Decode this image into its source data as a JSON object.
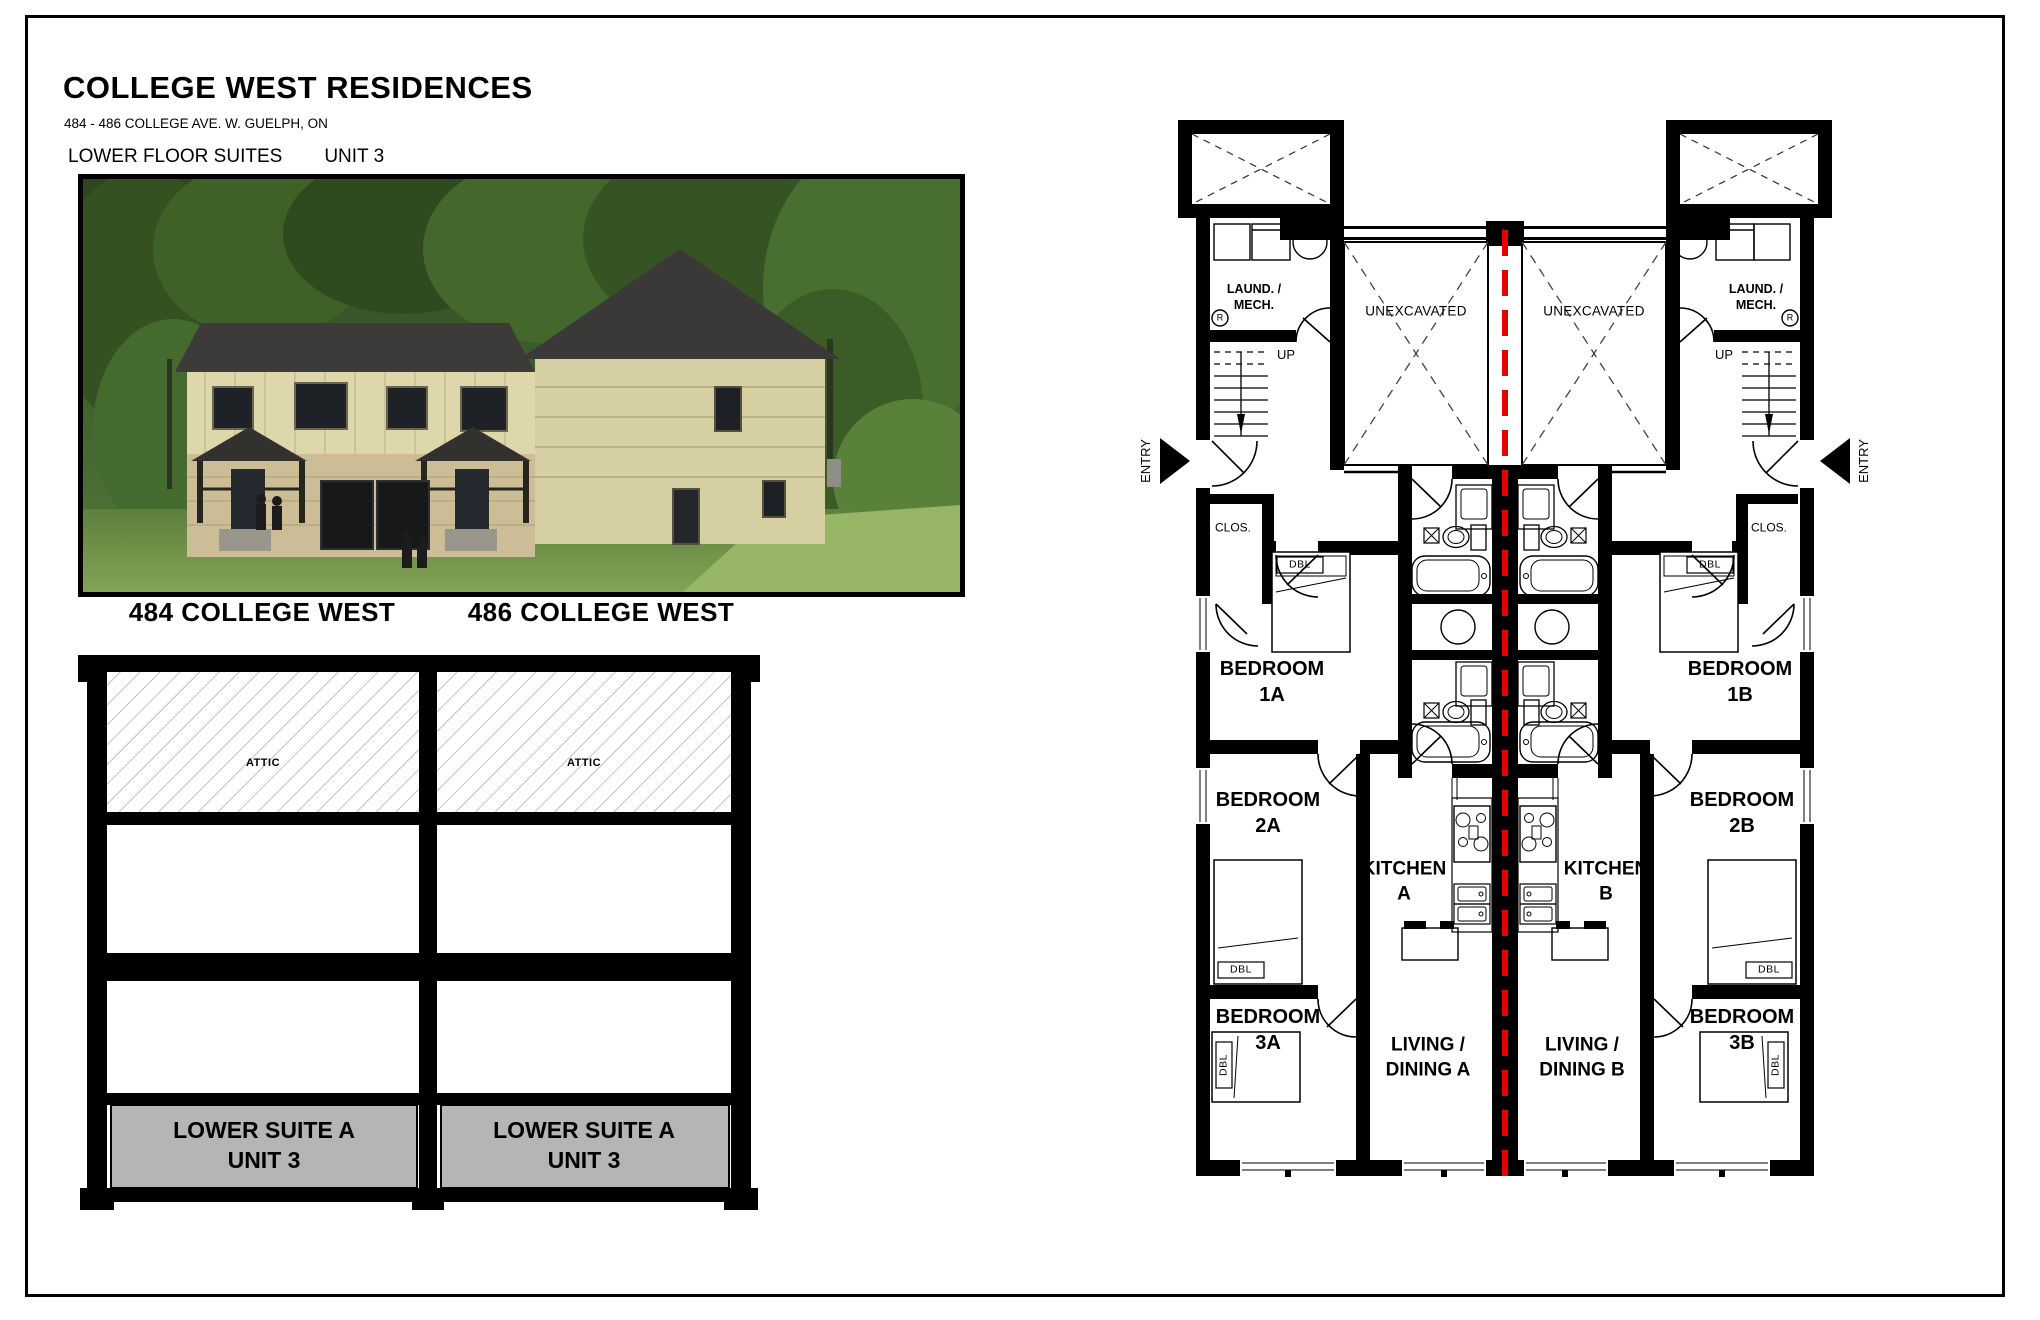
{
  "header": {
    "title": "COLLEGE WEST RESIDENCES",
    "address": "484 - 486 COLLEGE AVE. W. GUELPH, ON",
    "floor_label": "LOWER FLOOR SUITES",
    "unit_label": "UNIT 3"
  },
  "photo": {
    "caption_left": "484 COLLEGE WEST",
    "caption_right": "486 COLLEGE WEST"
  },
  "section": {
    "attic_label": "ATTIC",
    "suite_label": "LOWER SUITE A\nUNIT 3"
  },
  "plan": {
    "unexcavated_label": "UNEXCAVATED",
    "laundry_label": "LAUND. /\nMECH.",
    "up_label": "UP",
    "entry_label": "ENTRY",
    "closet_label": "CLOS.",
    "bed_label": "DBL",
    "meter_label": "R",
    "rooms": {
      "bedroom_1a": "BEDROOM\n1A",
      "bedroom_2a": "BEDROOM\n2A",
      "bedroom_3a": "BEDROOM\n3A",
      "bedroom_1b": "BEDROOM\n1B",
      "bedroom_2b": "BEDROOM\n2B",
      "bedroom_3b": "BEDROOM\n3B",
      "kitchen_a": "KITCHEN\nA",
      "kitchen_b": "KITCHEN\nB",
      "living_a": "LIVING /\nDINING A",
      "living_b": "LIVING /\nDINING B"
    }
  },
  "colors": {
    "centerline_red": "#e60000",
    "suite_gray": "#b5b5b5"
  }
}
